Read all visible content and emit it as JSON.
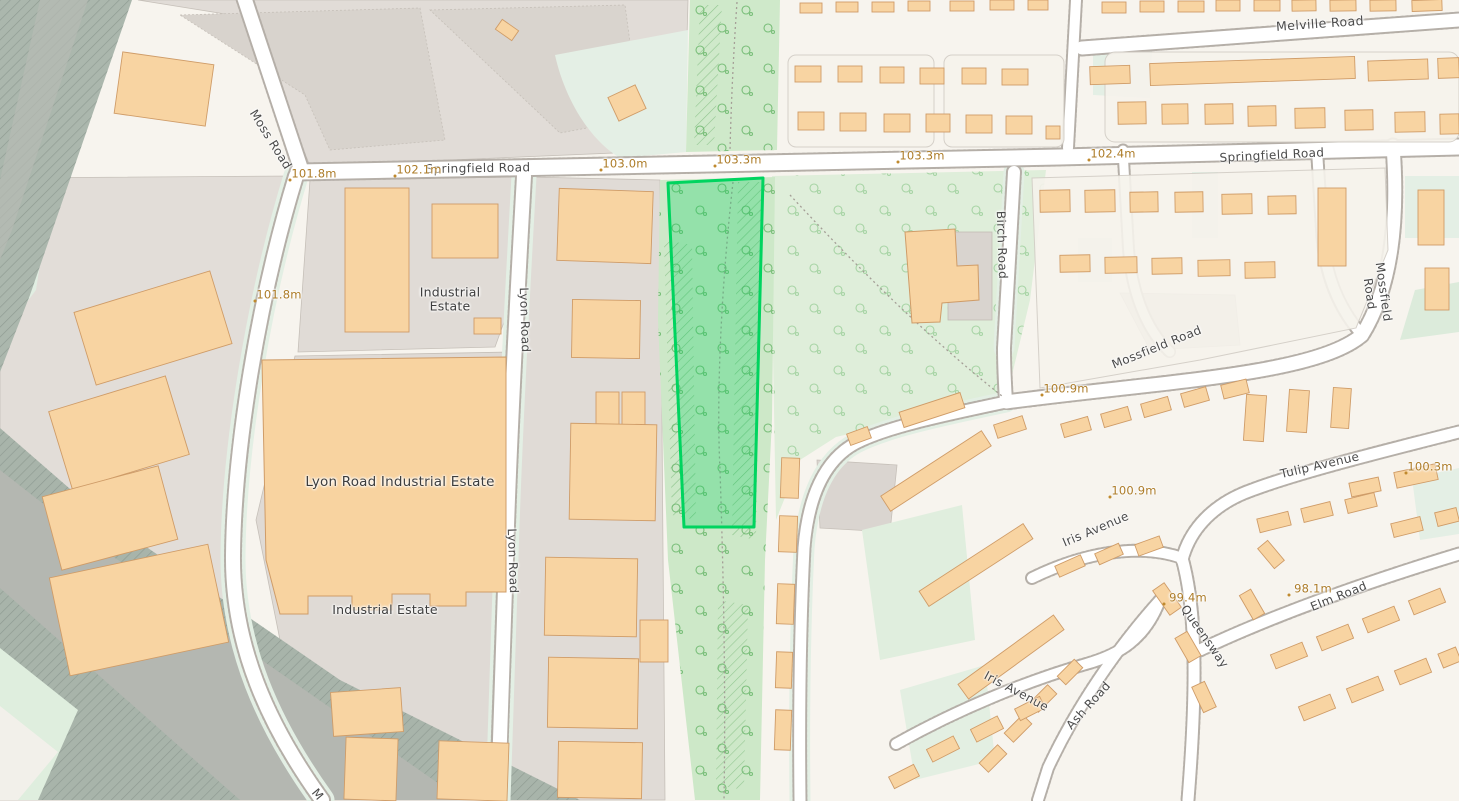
{
  "map": {
    "type": "street-map-with-selected-parcel",
    "colors": {
      "selection_stroke": "#00d45f",
      "selection_fill": "rgba(0,208,92,0.28)",
      "road_label": "#4a4a4a",
      "elevation_label": "#ad7c28",
      "woodland": "#cfe9ca",
      "industrial": "#e1dcd7",
      "building": "#f8d4a2",
      "residential": "#f7f4ee"
    },
    "selection": {
      "points": "668,183 763,178 754,527 684,527"
    },
    "road_labels": [
      {
        "text": "Melville Road",
        "x": 1320,
        "y": 24,
        "rot": -4,
        "size": 12.5
      },
      {
        "text": "Springfield Road",
        "x": 478,
        "y": 169,
        "rot": -1,
        "size": 12
      },
      {
        "text": "Springfield Road",
        "x": 1272,
        "y": 156,
        "rot": -3,
        "size": 12
      },
      {
        "text": "Moss Road",
        "x": 270,
        "y": 140,
        "rot": 58,
        "size": 12
      },
      {
        "text": "Lyon Road",
        "x": 524,
        "y": 320,
        "rot": 88,
        "size": 12
      },
      {
        "text": "Lyon Road",
        "x": 512,
        "y": 561,
        "rot": 88,
        "size": 12
      },
      {
        "text": "Birch Road",
        "x": 1001,
        "y": 245,
        "rot": 88,
        "size": 12
      },
      {
        "text": "Mossfield Road",
        "x": 1157,
        "y": 348,
        "rot": -22,
        "size": 12
      },
      {
        "text": "Mossfield  Road",
        "x": 1376,
        "y": 293,
        "rot": 82,
        "size": 12
      },
      {
        "text": "Tulip Avenue",
        "x": 1320,
        "y": 466,
        "rot": -13,
        "size": 12
      },
      {
        "text": "Iris Avenue",
        "x": 1096,
        "y": 530,
        "rot": -23,
        "size": 12
      },
      {
        "text": "Queensway",
        "x": 1204,
        "y": 637,
        "rot": 55,
        "size": 12
      },
      {
        "text": "Ash Road",
        "x": 1089,
        "y": 706,
        "rot": -48,
        "size": 12
      },
      {
        "text": "Elm Road",
        "x": 1339,
        "y": 597,
        "rot": -22,
        "size": 12
      },
      {
        "text": "Iris Avenue",
        "x": 1016,
        "y": 692,
        "rot": 28,
        "size": 12
      },
      {
        "text": "M",
        "x": 317,
        "y": 795,
        "rot": 50,
        "size": 12
      }
    ],
    "area_labels": [
      {
        "text": "Industrial\nEstate",
        "x": 450,
        "y": 300,
        "size": 12.5
      },
      {
        "text": "Lyon Road Industrial Estate",
        "x": 400,
        "y": 483,
        "size": 13.5
      },
      {
        "text": "Industrial Estate",
        "x": 385,
        "y": 610,
        "size": 12.5
      }
    ],
    "elevation_labels": [
      {
        "text": "101.8m",
        "x": 314,
        "y": 174
      },
      {
        "text": "102.1m",
        "x": 419,
        "y": 170
      },
      {
        "text": "103.0m",
        "x": 625,
        "y": 164
      },
      {
        "text": "103.3m",
        "x": 739,
        "y": 160
      },
      {
        "text": "103.3m",
        "x": 922,
        "y": 156
      },
      {
        "text": "102.4m",
        "x": 1113,
        "y": 154
      },
      {
        "text": "101.8m",
        "x": 279,
        "y": 295
      },
      {
        "text": "100.9m",
        "x": 1066,
        "y": 389
      },
      {
        "text": "100.9m",
        "x": 1134,
        "y": 491
      },
      {
        "text": "100.3m",
        "x": 1430,
        "y": 467
      },
      {
        "text": "99.4m",
        "x": 1188,
        "y": 598
      },
      {
        "text": "98.1m",
        "x": 1313,
        "y": 589
      }
    ]
  }
}
